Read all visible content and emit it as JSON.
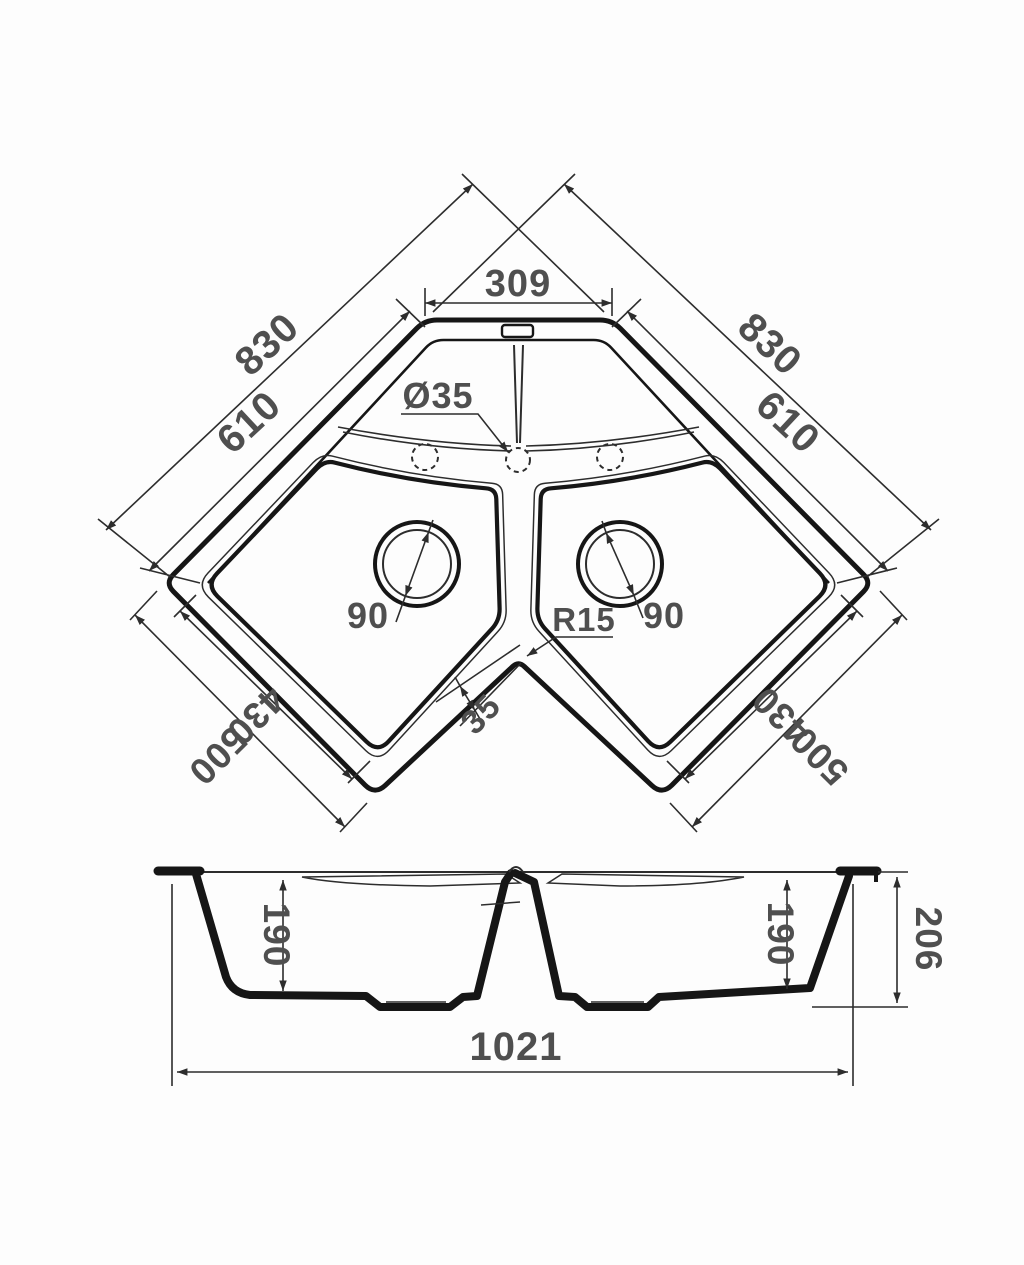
{
  "drawing": {
    "colors": {
      "background": "#fdfdfd",
      "line": "#161616",
      "dimension_text": "#4f4f4f"
    },
    "top_view": {
      "outer_edge_left_label": "830",
      "outer_edge_right_label": "830",
      "inner_edge_left_label": "610",
      "inner_edge_right_label": "610",
      "back_edge_label": "309",
      "faucet_hole_label": "Ø35",
      "drain_left_label": "90",
      "drain_right_label": "90",
      "corner_radius_label": "R15",
      "rim_width_label": "35",
      "bowl_edge_left_label": "430",
      "bowl_edge_right_label": "430",
      "front_edge_left_label": "500",
      "front_edge_right_label": "500"
    },
    "side_view": {
      "left_bowl_depth_label": "190",
      "right_bowl_depth_label": "190",
      "overall_height_label": "206",
      "overall_width_label": "1021"
    }
  }
}
